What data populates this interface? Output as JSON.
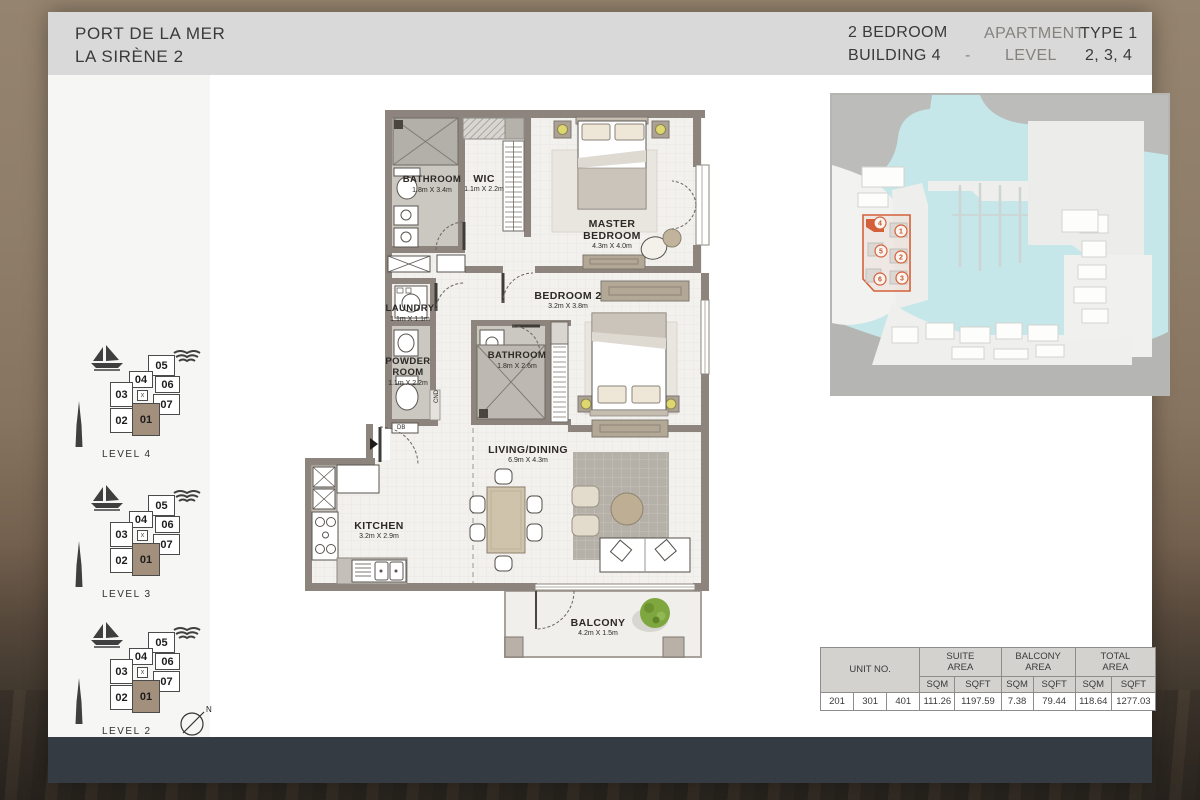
{
  "header": {
    "project": "PORT DE LA MER",
    "subproject": "LA SIRÈNE 2",
    "unit_type": "2 BEDROOM",
    "building": "BUILDING 4",
    "separator": "-",
    "apartment_label": "APARTMENT",
    "type_value": "TYPE 1",
    "level_label": "LEVEL",
    "level_values": "2, 3, 4"
  },
  "sidebar": {
    "units": [
      "05",
      "04",
      "06",
      "03",
      "07",
      "02",
      "01"
    ],
    "highlighted_unit": "01",
    "elevator_mark": "x",
    "levels": [
      {
        "label": "LEVEL 4"
      },
      {
        "label": "LEVEL 3"
      },
      {
        "label": "LEVEL 2"
      }
    ],
    "compass_label": "N"
  },
  "floorplan": {
    "rooms": [
      {
        "name": "BATHROOM",
        "dims": "1.8m X 3.4m"
      },
      {
        "name": "WIC",
        "dims": "1.1m X 2.2m"
      },
      {
        "name": "MASTER BEDROOM",
        "dims": "4.3m X 4.0m"
      },
      {
        "name": "LAUNDRY",
        "dims": "1.1m X 1.1m"
      },
      {
        "name": "BEDROOM 2",
        "dims": "3.2m X 3.8m"
      },
      {
        "name": "POWDER ROOM",
        "dims": "1.1m X 2.2m"
      },
      {
        "name": "BATHROOM",
        "dims": "1.8m X 2.6m"
      },
      {
        "name": "LIVING/DINING",
        "dims": "6.9m X 4.3m"
      },
      {
        "name": "KITCHEN",
        "dims": "3.2m X 2.9m"
      },
      {
        "name": "BALCONY",
        "dims": "4.2m X 1.5m"
      }
    ],
    "labels": {
      "db": "DB",
      "cnd": "CND"
    }
  },
  "sitemap": {
    "markers": [
      "1",
      "2",
      "3",
      "4",
      "5",
      "6"
    ],
    "highlighted_building": "4",
    "accent_color": "#d4603a",
    "water_color": "#c6e7e9"
  },
  "areas_table": {
    "unit_no": "UNIT NO.",
    "sqm": "SQM",
    "sqft": "SQFT",
    "groups": [
      {
        "title": "SUITE\nAREA"
      },
      {
        "title": "BALCONY\nAREA"
      },
      {
        "title": "TOTAL\nAREA"
      }
    ],
    "units": [
      "201",
      "301",
      "401"
    ],
    "values": [
      "111.26",
      "1197.59",
      "7.38",
      "79.44",
      "118.64",
      "1277.03"
    ]
  }
}
